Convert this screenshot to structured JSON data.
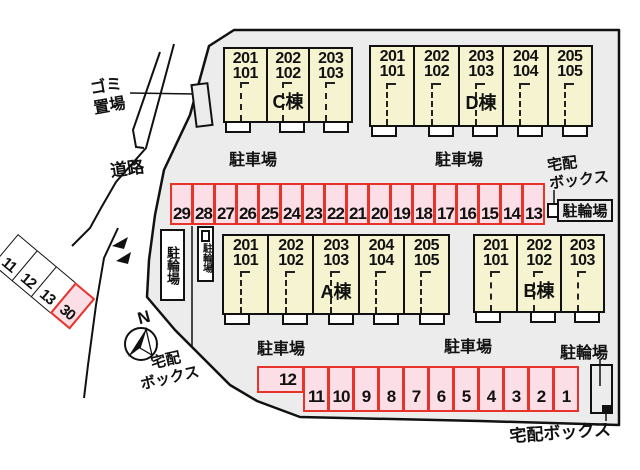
{
  "colors": {
    "site_bg": "#ECECEC",
    "building_fill": "#F6F3D0",
    "stall_fill": "#FBDEE6",
    "stall_border": "#E8332A",
    "line": "#111111"
  },
  "labels": {
    "road": "道路",
    "garbage_l1": "ゴミ",
    "garbage_l2": "置場",
    "parking_lot": "駐車場",
    "bicycle": "駐輪場",
    "delivery_l1": "宅配",
    "delivery_l2": "ボックス",
    "delivery_full": "宅配ボックス",
    "north": "N"
  },
  "buildings": [
    {
      "key": "C",
      "name": "C棟",
      "units": [
        {
          "top": "201",
          "bottom": "101"
        },
        {
          "top": "202",
          "bottom": "102"
        },
        {
          "top": "203",
          "bottom": "103"
        }
      ]
    },
    {
      "key": "D",
      "name": "D棟",
      "units": [
        {
          "top": "201",
          "bottom": "101"
        },
        {
          "top": "202",
          "bottom": "102"
        },
        {
          "top": "203",
          "bottom": "103"
        },
        {
          "top": "204",
          "bottom": "104"
        },
        {
          "top": "205",
          "bottom": "105"
        }
      ]
    },
    {
      "key": "A",
      "name": "A棟",
      "units": [
        {
          "top": "201",
          "bottom": "101"
        },
        {
          "top": "202",
          "bottom": "102"
        },
        {
          "top": "203",
          "bottom": "103"
        },
        {
          "top": "204",
          "bottom": "104"
        },
        {
          "top": "205",
          "bottom": "105"
        }
      ]
    },
    {
      "key": "B",
      "name": "B棟",
      "units": [
        {
          "top": "201",
          "bottom": "101"
        },
        {
          "top": "202",
          "bottom": "102"
        },
        {
          "top": "203",
          "bottom": "103"
        }
      ]
    }
  ],
  "parking": {
    "middle_row": [
      "29",
      "28",
      "27",
      "26",
      "25",
      "24",
      "23",
      "22",
      "21",
      "20",
      "19",
      "18",
      "17",
      "16",
      "15",
      "14",
      "13"
    ],
    "bottom_single": "12",
    "bottom_row": [
      "11",
      "10",
      "9",
      "8",
      "7",
      "6",
      "5",
      "4",
      "3",
      "2",
      "1"
    ],
    "street_row": [
      "11",
      "12",
      "13",
      "30"
    ],
    "street_row_highlight": "30"
  }
}
